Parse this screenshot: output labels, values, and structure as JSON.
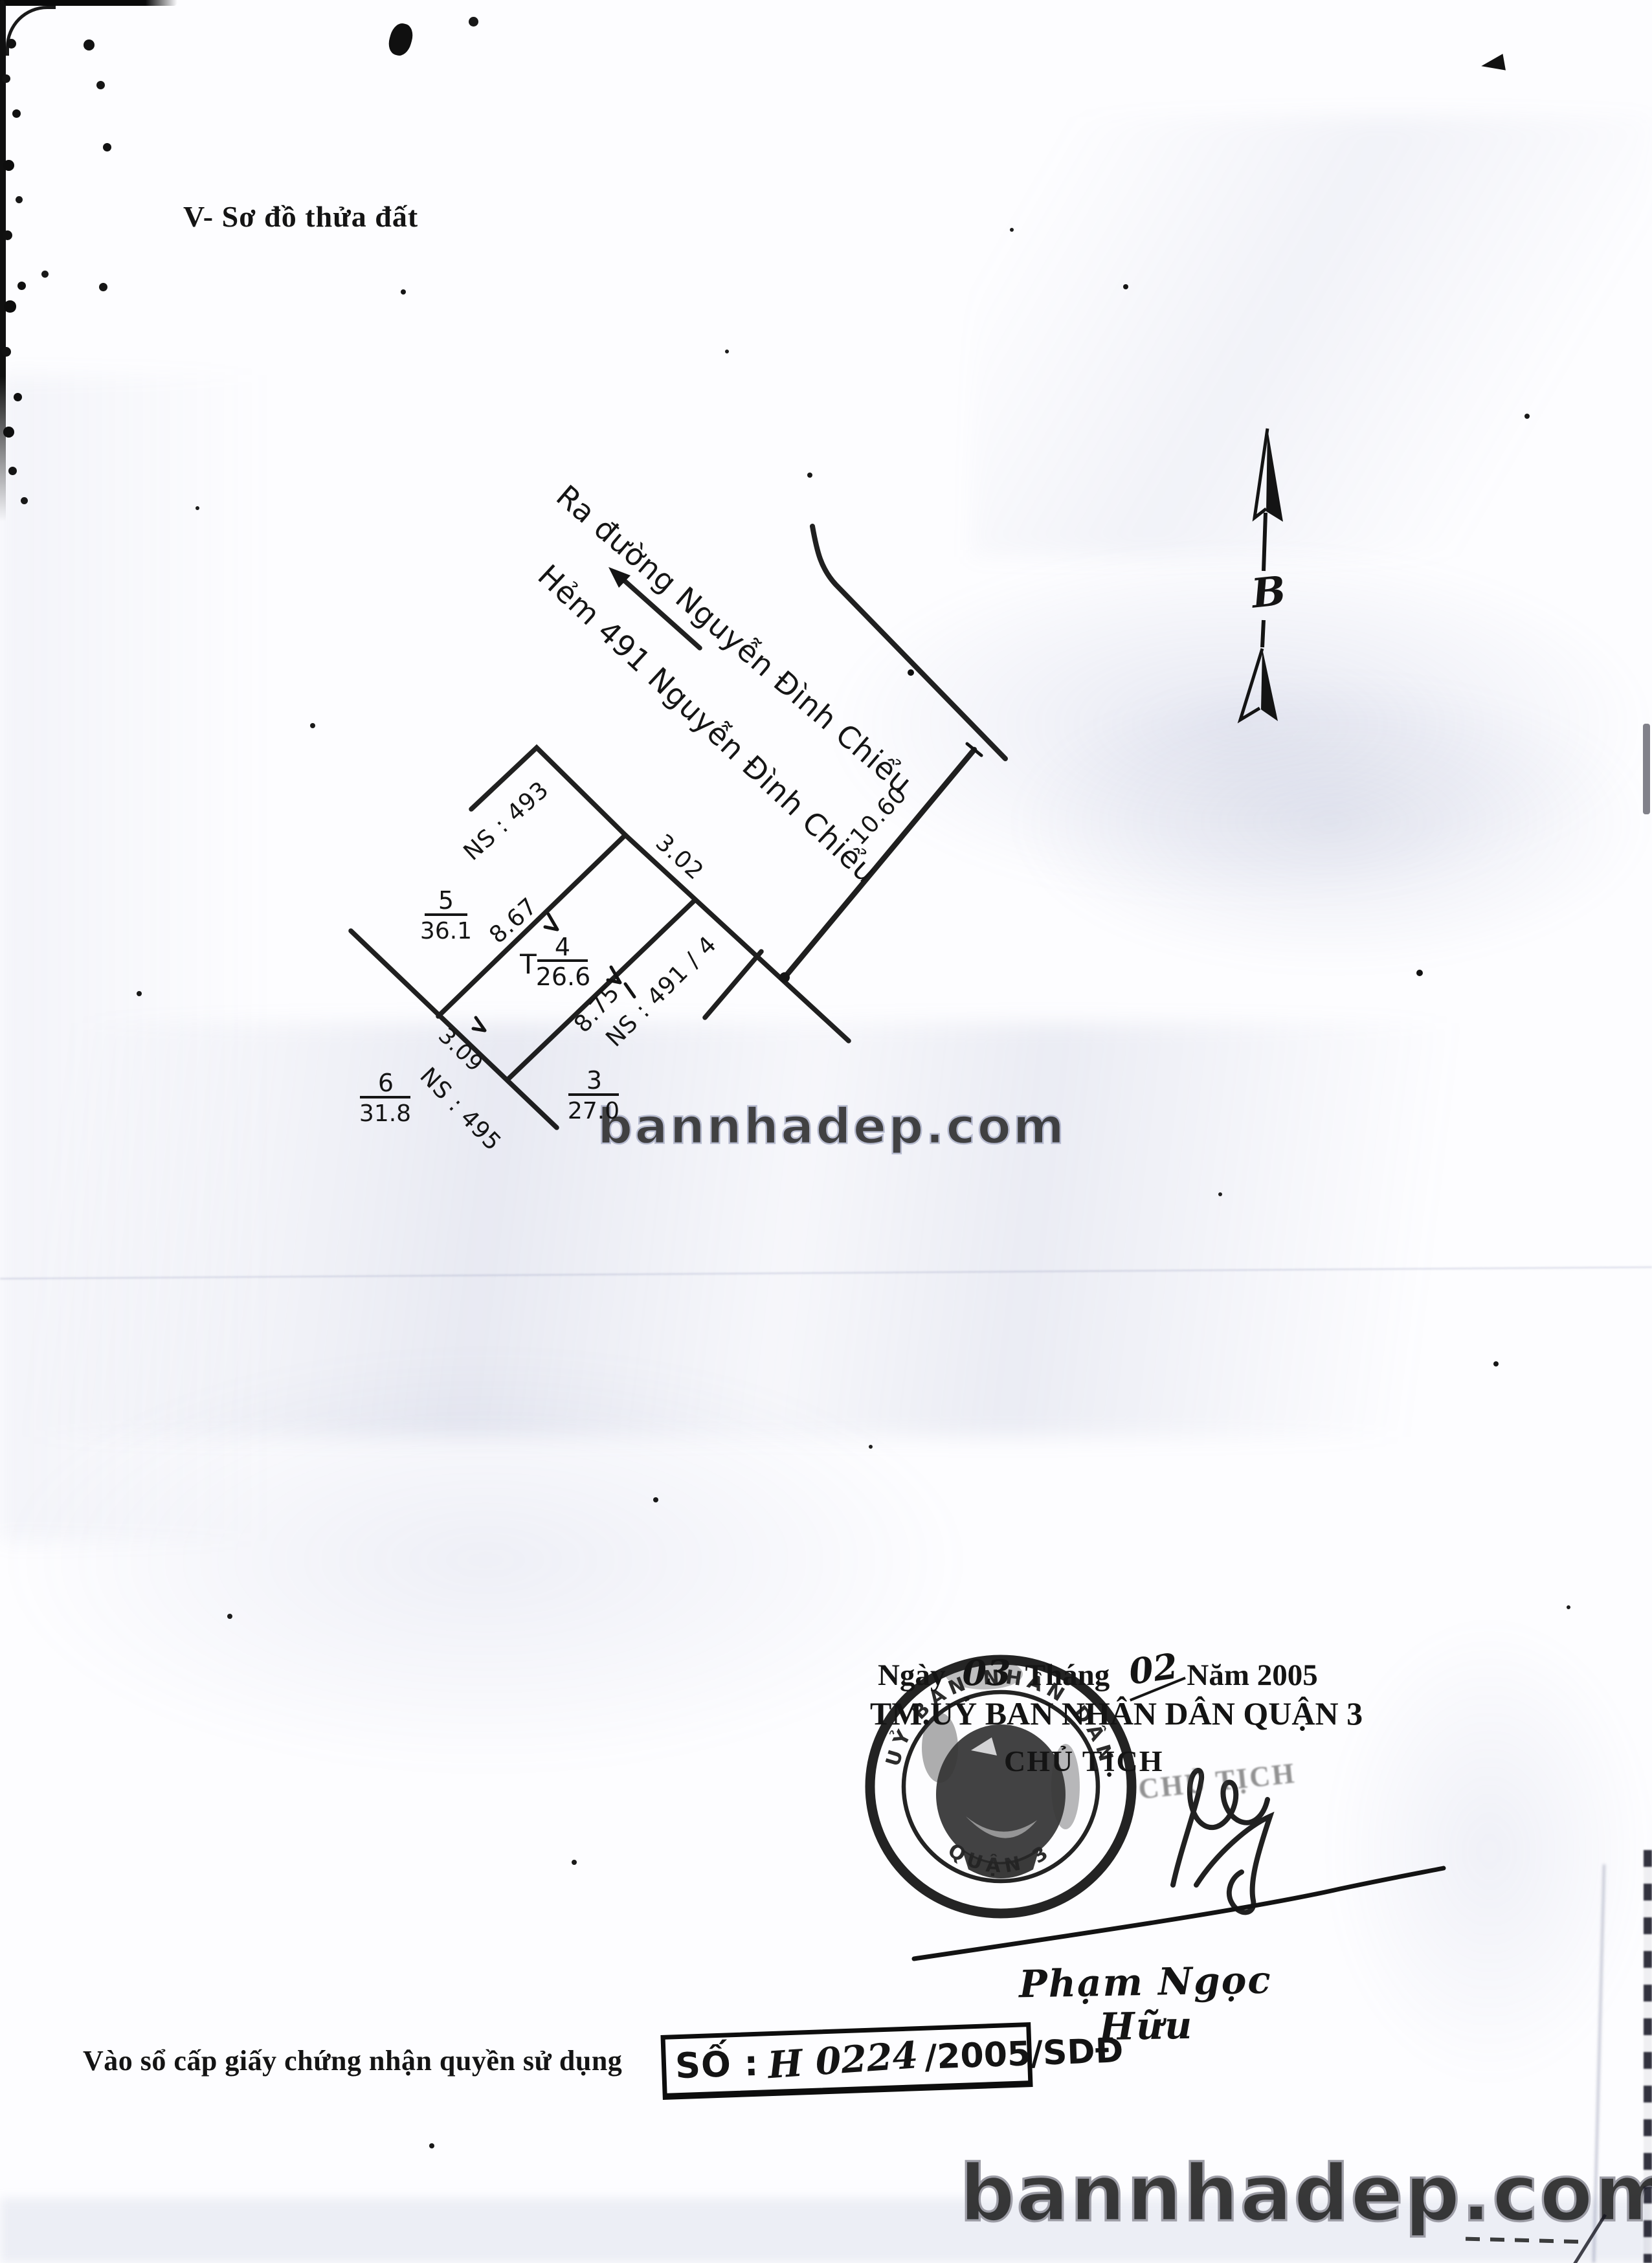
{
  "document": {
    "section_title": "V- Sơ đồ thửa đất",
    "watermark": "bannhadep.com"
  },
  "diagram": {
    "street_direction_label": "Ra đường Nguyễn Đình Chiểu",
    "alley_label": "Hẻm 491 Nguyễn Đình Chiểu",
    "north_symbol": "B",
    "dims": {
      "alley_frontage": "10.60",
      "edge_top_right": "3.02",
      "edge_upper_left": "8.67",
      "edge_lower_right": "8.75",
      "edge_bottom_left": "3.09"
    },
    "parcel_4": {
      "marker": "T",
      "id": "4",
      "area": "26.6"
    },
    "parcel_5": {
      "id": "5",
      "area": "36.1"
    },
    "parcel_6": {
      "id": "6",
      "area": "31.8"
    },
    "parcel_3": {
      "id": "3",
      "area": "27.0"
    },
    "neighbor_left": "NS : 493",
    "neighbor_right": "NS : 491 / 4",
    "neighbor_bottom": "NS : 495"
  },
  "approval": {
    "date_word_day": "Ngày",
    "date_day": "03",
    "date_word_month": "Tháng",
    "date_month": "02",
    "date_year": "Năm 2005",
    "committee_line": "TM.UỶ BAN NHÂN DÂN QUẬN 3",
    "chairman_title": "CHỦ TỊCH",
    "stamp_echo": "CHỦ TỊCH",
    "signer_name": "Phạm Ngọc Hữu",
    "seal_arc_top": "UỶ BAN NHÂN DÂN",
    "seal_arc_bottom": "QUẬN 3"
  },
  "registry": {
    "label": "Vào sổ cấp giấy chứng nhận quyền sử dụng",
    "no_prefix": "SỐ :",
    "no_handwritten": "H 0224",
    "no_suffix": "/2005/SDĐ"
  }
}
